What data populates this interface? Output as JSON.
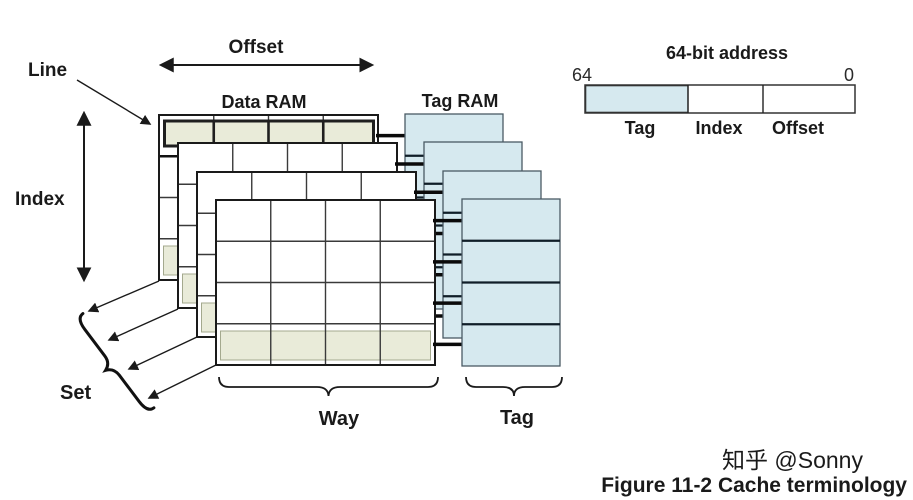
{
  "figure": {
    "caption": "Figure 11-2 Cache terminology",
    "watermark": "知乎 @Sonny"
  },
  "diagram": {
    "line_label": "Line",
    "offset_arrow_label": "Offset",
    "data_ram_label": "Data RAM",
    "tag_ram_label": "Tag RAM",
    "index_label": "Index",
    "set_label": "Set",
    "way_label": "Way",
    "tag_brace_label": "Tag",
    "ways_shown": 4,
    "rows_per_way": 4,
    "cols_per_way": 4
  },
  "address": {
    "title": "64-bit address",
    "high_bit": "64",
    "low_bit": "0",
    "fields": [
      "Tag",
      "Index",
      "Offset"
    ]
  },
  "colors": {
    "highlight": "#e9ebd9",
    "tag_fill": "#d6e9ef",
    "ink": "#1a1a1a",
    "watermark": "#c4c4c4"
  }
}
